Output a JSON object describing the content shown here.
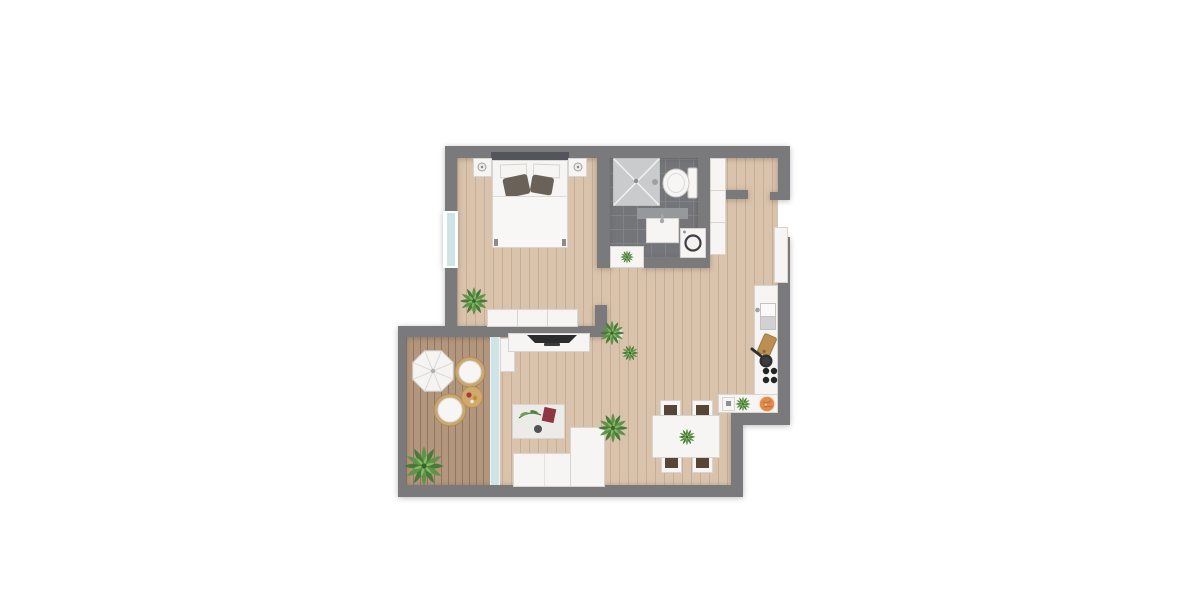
{
  "scene": {
    "type": "apartment-floor-plan-top-view",
    "rooms": [
      {
        "name": "bedroom",
        "items": [
          "double-bed",
          "white-pillows",
          "dark-pillows",
          "nightstand-left",
          "nightstand-right",
          "dresser",
          "potted-plant",
          "window"
        ]
      },
      {
        "name": "bathroom",
        "items": [
          "shower",
          "toilet",
          "vanity-sink",
          "washing-machine",
          "door-mat",
          "small-plant"
        ]
      },
      {
        "name": "entry",
        "items": [
          "entrance-door",
          "wardrobe",
          "partition-wall"
        ]
      },
      {
        "name": "kitchen",
        "items": [
          "counter-l-shape",
          "sink",
          "faucet",
          "cutting-board",
          "frying-pan",
          "cooktop-4-burners",
          "small-appliance",
          "counter-plant",
          "fruit-plate"
        ]
      },
      {
        "name": "dining-area",
        "items": [
          "dining-table",
          "chair-top-left",
          "chair-top-right",
          "chair-bottom-left",
          "chair-bottom-right",
          "table-plant"
        ]
      },
      {
        "name": "living-room",
        "items": [
          "tv-sideboard",
          "tv",
          "coffee-table",
          "decor-sprig",
          "red-book",
          "bowl",
          "corner-sofa",
          "floor-plant-large",
          "floor-plant-small",
          "sofa-plant"
        ]
      },
      {
        "name": "balcony",
        "items": [
          "wood-deck",
          "parasol",
          "lounge-chair-1",
          "lounge-chair-2",
          "side-table",
          "snack-plate",
          "potted-plant",
          "sliding-glass-door",
          "door-leaf"
        ]
      }
    ]
  },
  "colors": {
    "background": "#ffffff",
    "wall": "#7a797c",
    "wood_floor": "#d9c3ac",
    "wood_grain": "#c9ae92",
    "deck": "#b2967d",
    "deck_line": "#93775d",
    "tile": "#747579",
    "tile_line": "#828388",
    "glass": "#cfe4e7",
    "furniture_white": "#f6f5f3",
    "furniture_border": "#d8d5d0",
    "pillow_dark": "#6a6258",
    "headboard": "#54555a",
    "tv": "#2b2c2e",
    "plant_green": "#5f9347",
    "plant_green_dark": "#487a38",
    "plant_green_light": "#84b968",
    "rattan": "#c9a874",
    "chair_seat": "#574636",
    "cutting_board": "#bb8f51",
    "orange_plate": "#df8b4d",
    "red_accent": "#8e3742",
    "shower": "#c9cbcd"
  }
}
